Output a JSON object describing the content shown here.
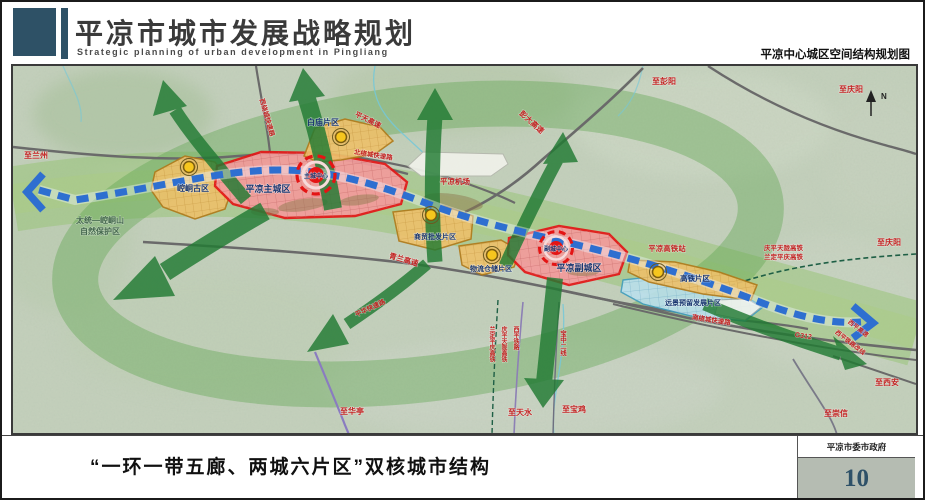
{
  "header": {
    "title": "平凉市城市发展战略规划",
    "subtitle_en": "Strategic planning of urban development in Pingliang",
    "map_label": "平凉中心城区空间结构规划图"
  },
  "map": {
    "zones": {
      "baimiao": "白庙片区",
      "kongtong": "崆峒古区",
      "main_city": "平凉主城区",
      "main_center": "主城中心",
      "shangmao": "商贸批发片区",
      "wuliu": "物流仓储片区",
      "sub_city": "平凉副城区",
      "sub_center": "副城中心",
      "gaotie": "高铁片区",
      "reserved": "远景预留发展片区"
    },
    "roads": {
      "pengda": "彭大高速",
      "pingtian": "平天高速",
      "qinglan": "青兰高速",
      "g312": "G312",
      "west_ring": "西绕城快速路",
      "north_ring": "北绕城快速路",
      "south_ring": "南绕城快速路",
      "pinghua": "平华快速路",
      "xiping_exp": "西平高速",
      "xiping_rail_div": "西平铁路改线"
    },
    "railways": {
      "qingping_tianlong": "庆平天陇高铁",
      "landing_pingqing": "兰定平庆高铁",
      "xiping": "西平铁路",
      "baozhong": "宝中二线"
    },
    "pois": {
      "airport": "平凉机场",
      "hsr_station": "平凉高铁站",
      "nature_reserve_line1": "太统—崆峒山",
      "nature_reserve_line2": "自然保护区"
    },
    "destinations": {
      "lanzhou": "至兰州",
      "pengyang": "至彭阳",
      "qingyang_top": "至庆阳",
      "qingyang_right": "至庆阳",
      "xian": "至西安",
      "chongxin": "至崇信",
      "huating": "至华亭",
      "tianshui": "至天水",
      "baoji": "至宝鸡"
    },
    "compass_n": "N",
    "colors": {
      "corridor_green": "#217a33",
      "axis_blue": "#2e6fd0",
      "city_red": "#e31717",
      "city_fill": "#f29b9b",
      "district_orange": "#ecc06b",
      "reserved_blue": "#badfec",
      "node_yellow": "#f6c61e",
      "label_red": "#c32222",
      "label_navy": "#18356f",
      "terrain": "#c5d1bd"
    }
  },
  "footer": {
    "caption": "“一环一带五廊、两城六片区”双核城市结构",
    "org": "平凉市委市政府",
    "page_number": "10"
  }
}
